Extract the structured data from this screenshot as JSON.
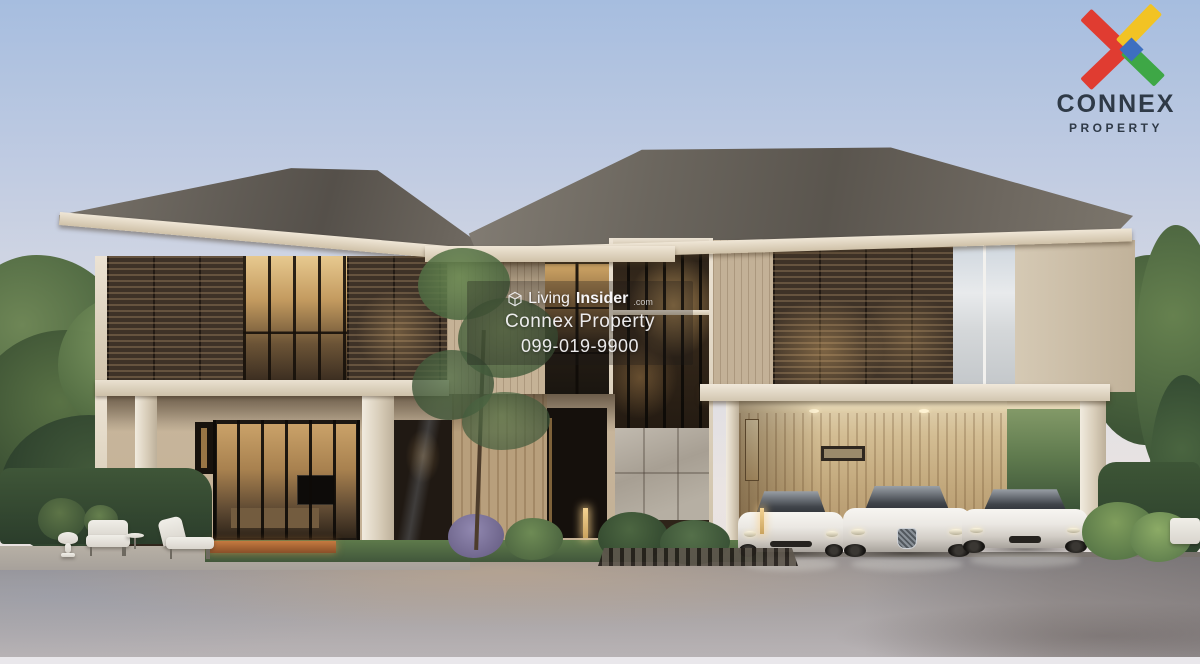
{
  "photo": {
    "kind": "property-listing-photograph",
    "subject": "Modern two-storey luxury house with wood louver facade, glass tower, carport and three white sports cars"
  },
  "watermark": {
    "brand_first": "Living",
    "brand_second": "Insider",
    "brand_tld": ".com",
    "agency": "Connex Property",
    "phone": "099-019-9900"
  },
  "corner_logo": {
    "wordmark": "CONNEX",
    "subtitle": "PROPERTY"
  },
  "icons": {
    "watermark_brand": "cube-outline-icon",
    "corner": "connex-x-icon"
  },
  "colors": {
    "sky-top": "#a6bddf",
    "sky-bottom": "#eae4e2",
    "roof": "#6b655c",
    "fascia": "#ddd2bf",
    "wood-dark": "#3e3227",
    "wood-warm": "#c9a36a",
    "wall-beige": "#c8b69d",
    "carport-wall": "#c3a87f",
    "glass-sky": "#ccd4da",
    "stone": "#b5aea2",
    "foliage": "#5d7a4b",
    "foliage-dark": "#3e5637",
    "driveway": "#a3a0a2",
    "car-white": "#d2cdc6",
    "watermark-text": "#f5f4f6",
    "logo-red": "#e03c31",
    "logo-yellow": "#f2c324",
    "logo-green": "#3ea746",
    "logo-blue": "#3d6fc0",
    "logo-navy": "#2f3a47"
  }
}
